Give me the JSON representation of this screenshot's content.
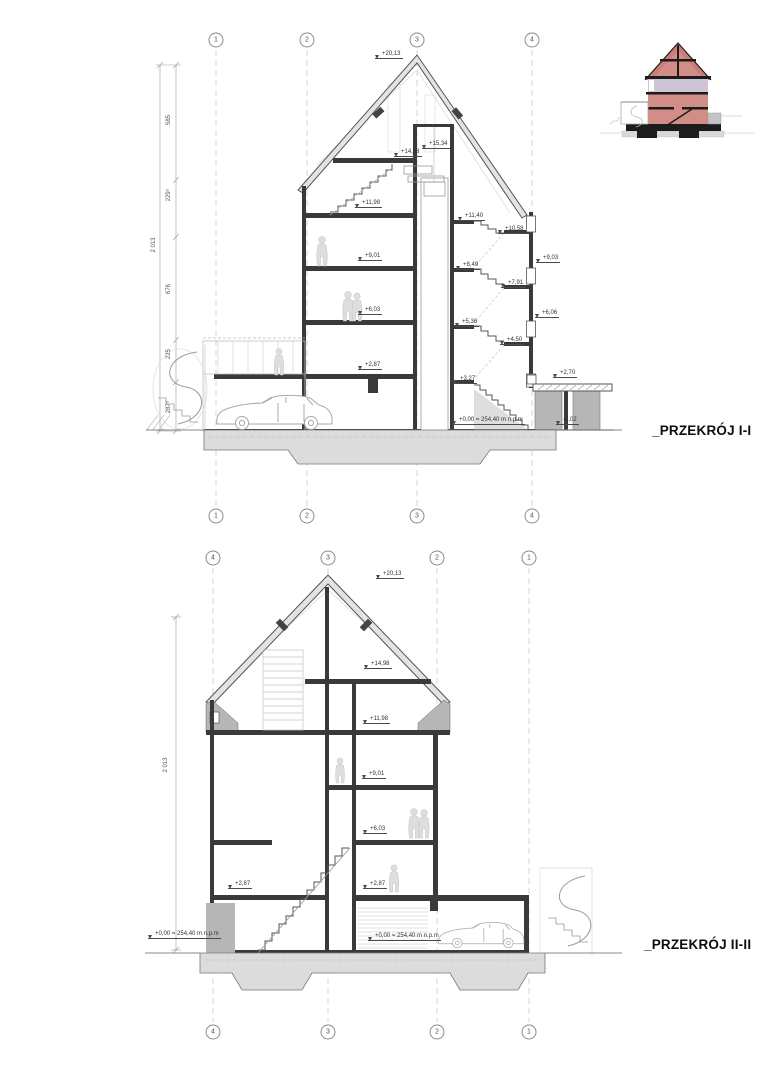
{
  "sheet": {
    "background": "#ffffff"
  },
  "colors": {
    "wall": "#3a3a3a",
    "line": "#555555",
    "light": "#9a9a9a",
    "faint": "#c8c8c8",
    "poche": "#b6b6b6",
    "ground": "#dcdcdc",
    "roofband": "#e3e3e3",
    "sil": "#dedede",
    "silline": "#c9c9c9",
    "carline": "#a9a9a9",
    "tpink": "#d28d87",
    "troof": "#c97d77",
    "tband": "#cfc5d7",
    "tblack": "#1c1c1c",
    "tgray": "#c4c4c4"
  },
  "thumbnail": {
    "name": "building-section-minimap"
  },
  "section1": {
    "title": "_PRZEKRÓJ I-I",
    "grid_bubbles": [
      {
        "t": "1",
        "x": 216,
        "y": 40
      },
      {
        "t": "2",
        "x": 307,
        "y": 40
      },
      {
        "t": "3",
        "x": 417,
        "y": 40
      },
      {
        "t": "4",
        "x": 532,
        "y": 40
      },
      {
        "t": "1",
        "x": 216,
        "y": 516
      },
      {
        "t": "2",
        "x": 307,
        "y": 516
      },
      {
        "t": "3",
        "x": 417,
        "y": 516
      },
      {
        "t": "4",
        "x": 532,
        "y": 516
      }
    ],
    "levels": [
      {
        "t": "+20,13",
        "x": 375,
        "y": 50
      },
      {
        "t": "+15,34",
        "x": 422,
        "y": 140
      },
      {
        "t": "+14,98",
        "x": 394,
        "y": 148
      },
      {
        "t": "+11,98",
        "x": 355,
        "y": 199
      },
      {
        "t": "+11,40",
        "x": 458,
        "y": 212
      },
      {
        "t": "+10,58",
        "x": 498,
        "y": 225
      },
      {
        "t": "+9,03",
        "x": 536,
        "y": 254
      },
      {
        "t": "+9,01",
        "x": 358,
        "y": 252
      },
      {
        "t": "+8,49",
        "x": 456,
        "y": 261
      },
      {
        "t": "+7,91",
        "x": 501,
        "y": 279
      },
      {
        "t": "+6,06",
        "x": 535,
        "y": 309
      },
      {
        "t": "+6,03",
        "x": 358,
        "y": 306
      },
      {
        "t": "+5,36",
        "x": 455,
        "y": 318
      },
      {
        "t": "+4,50",
        "x": 500,
        "y": 336
      },
      {
        "t": "+3,27",
        "x": 453,
        "y": 375
      },
      {
        "t": "+2,87",
        "x": 358,
        "y": 361
      },
      {
        "t": "+2,70",
        "x": 553,
        "y": 369
      },
      {
        "t": "-0,02",
        "x": 556,
        "y": 416
      },
      {
        "t": "+0,00 = 254,40 m n.p.m",
        "x": 452,
        "y": 416
      }
    ],
    "dims": [
      {
        "t": "585",
        "x": 169,
        "y": 120
      },
      {
        "t": "229⁵",
        "x": 169,
        "y": 195
      },
      {
        "t": "676",
        "x": 169,
        "y": 289
      },
      {
        "t": "225",
        "x": 169,
        "y": 354
      },
      {
        "t": "287⁵",
        "x": 169,
        "y": 407
      },
      {
        "t": "2 013",
        "x": 154,
        "y": 245
      }
    ]
  },
  "section2": {
    "title": "_PRZEKRÓJ II-II",
    "grid_bubbles": [
      {
        "t": "4",
        "x": 213,
        "y": 558
      },
      {
        "t": "3",
        "x": 328,
        "y": 558
      },
      {
        "t": "2",
        "x": 437,
        "y": 558
      },
      {
        "t": "1",
        "x": 529,
        "y": 558
      },
      {
        "t": "4",
        "x": 213,
        "y": 1032
      },
      {
        "t": "3",
        "x": 328,
        "y": 1032
      },
      {
        "t": "2",
        "x": 437,
        "y": 1032
      },
      {
        "t": "1",
        "x": 529,
        "y": 1032
      }
    ],
    "levels": [
      {
        "t": "+20,13",
        "x": 376,
        "y": 570
      },
      {
        "t": "+14,98",
        "x": 364,
        "y": 660
      },
      {
        "t": "+11,98",
        "x": 363,
        "y": 715
      },
      {
        "t": "+9,01",
        "x": 362,
        "y": 770
      },
      {
        "t": "+6,03",
        "x": 363,
        "y": 825
      },
      {
        "t": "+2,87",
        "x": 363,
        "y": 880
      },
      {
        "t": "+2,87",
        "x": 228,
        "y": 880
      },
      {
        "t": "+0,00 = 254,40 m n.p.m",
        "x": 148,
        "y": 930
      },
      {
        "t": "+0,00 = 254,40 m n.p.m",
        "x": 368,
        "y": 932
      }
    ],
    "dims": [
      {
        "t": "2 013",
        "x": 166,
        "y": 765
      }
    ]
  }
}
